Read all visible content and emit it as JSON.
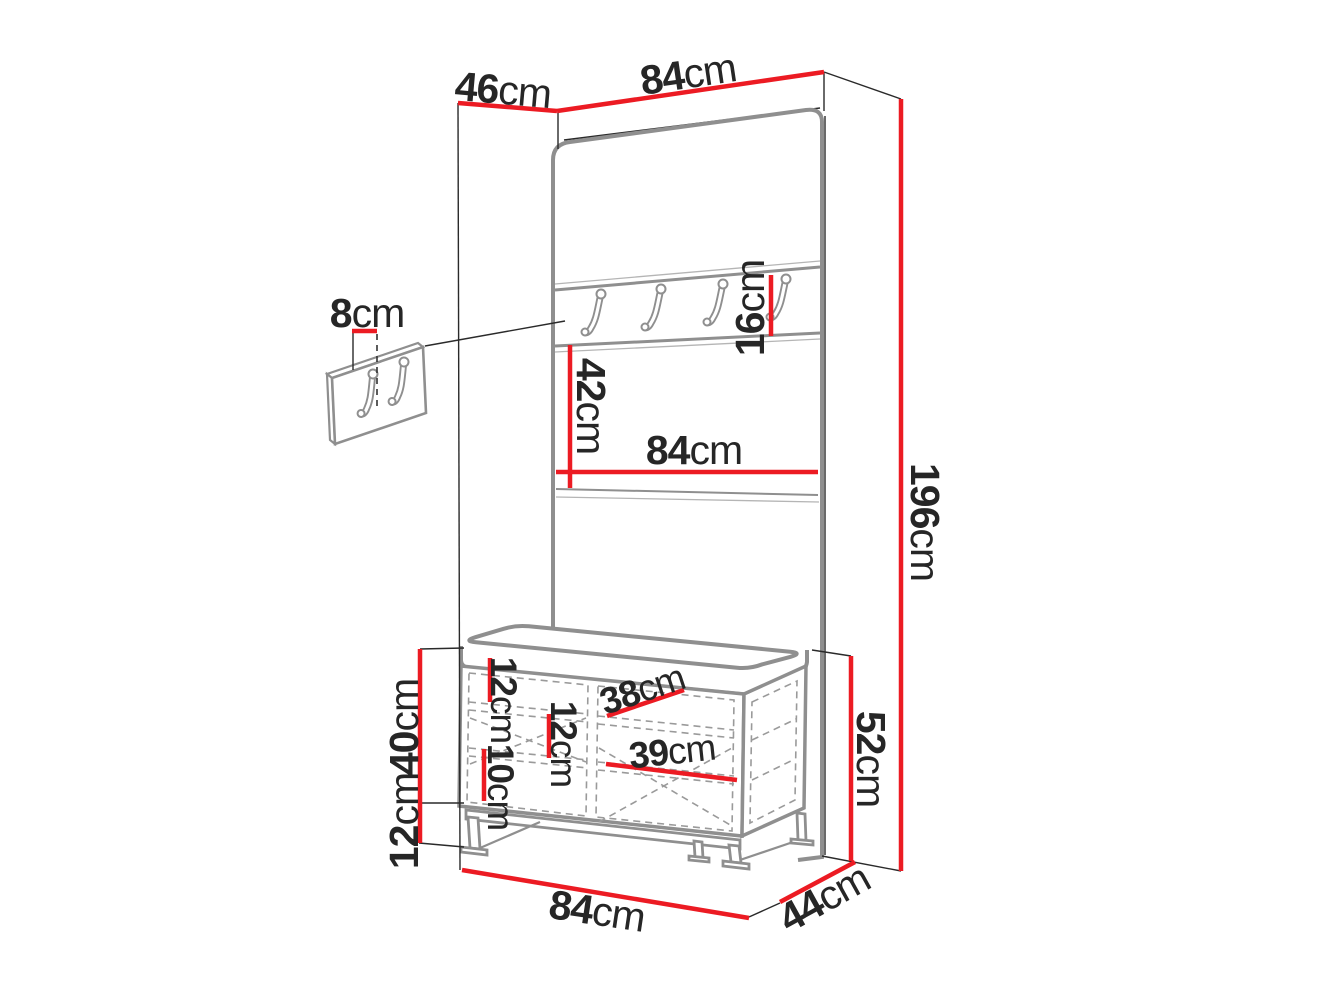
{
  "diagram": {
    "type": "furniture-dimension-diagram",
    "unit": "cm",
    "colors": {
      "dimension_line": "#ec1b23",
      "artwork_line": "#8f8f8f",
      "text": "#262626"
    },
    "dimensions": {
      "top_depth": {
        "value": "46",
        "unit": "cm"
      },
      "top_width": {
        "value": "84",
        "unit": "cm"
      },
      "total_height": {
        "value": "196",
        "unit": "cm"
      },
      "wall_hooks_offset": {
        "value": "8",
        "unit": "cm"
      },
      "hook_rail_height": {
        "value": "16",
        "unit": "cm"
      },
      "middle_section_height": {
        "value": "42",
        "unit": "cm"
      },
      "middle_width": {
        "value": "84",
        "unit": "cm"
      },
      "bench_gap_top": {
        "value": "12",
        "unit": "cm"
      },
      "bench_gap_middle": {
        "value": "12",
        "unit": "cm"
      },
      "bench_gap_bottom": {
        "value": "10",
        "unit": "cm"
      },
      "bench_shelf_width_top": {
        "value": "38",
        "unit": "cm"
      },
      "bench_shelf_width_bottom": {
        "value": "39",
        "unit": "cm"
      },
      "bench_body_height": {
        "value": "40",
        "unit": "cm"
      },
      "bench_leg_height": {
        "value": "12",
        "unit": "cm"
      },
      "bench_total_height": {
        "value": "52",
        "unit": "cm"
      },
      "bench_width": {
        "value": "84",
        "unit": "cm"
      },
      "bench_depth": {
        "value": "44",
        "unit": "cm"
      }
    }
  }
}
